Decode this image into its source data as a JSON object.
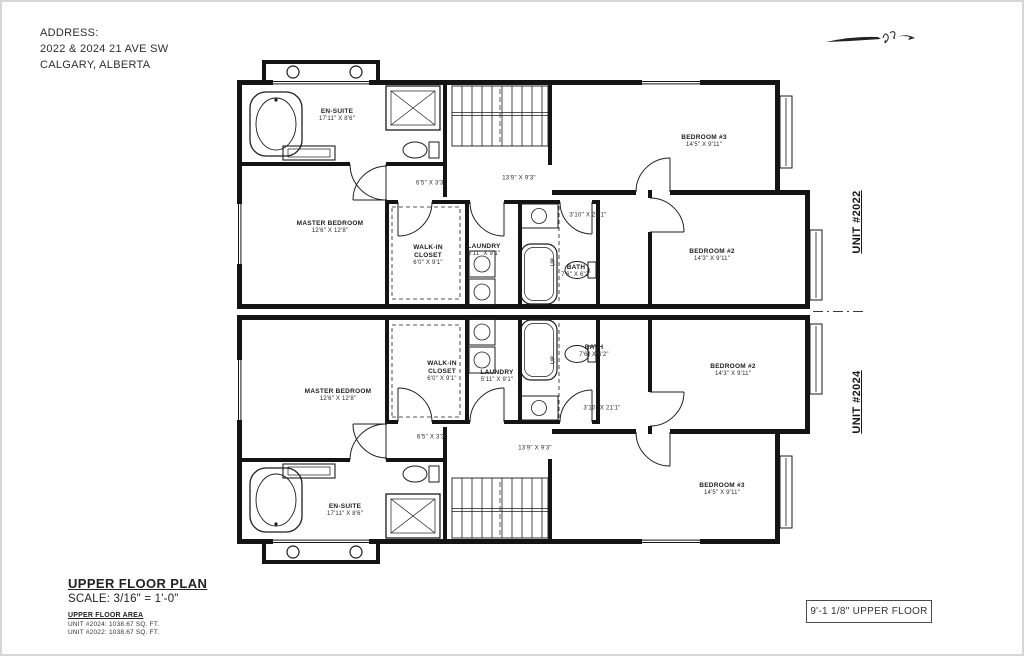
{
  "sheet": {
    "address": {
      "label": "ADDRESS:",
      "line1": "2022 & 2024 21 AVE SW",
      "line2": "CALGARY, ALBERTA"
    },
    "units": {
      "upper": "UNIT #2022",
      "lower": "UNIT #2024"
    },
    "title_block": {
      "title": "UPPER FLOOR PLAN",
      "scale": "SCALE: 3/16\" = 1'-0\"",
      "area_heading": "UPPER FLOOR AREA",
      "area_lines": [
        "UNIT #2024: 1038.67 SQ. FT.",
        "UNIT #2022: 1038.67 SQ. FT."
      ]
    },
    "elevation_tag": "9'-1 1/8\" UPPER FLOOR"
  },
  "rooms": {
    "ensuite": {
      "name": "EN-SUITE",
      "dims": "17'11\" X 8'6\""
    },
    "master": {
      "name": "MASTER BEDROOM",
      "dims": "12'6\" X 12'8\""
    },
    "wic": {
      "name": "WALK-IN CLOSET",
      "dims": "6'0\" X 9'1\""
    },
    "laundry": {
      "name": "LAUNDRY",
      "dims": "5'11\" X 9'1\""
    },
    "bath": {
      "name": "BATH",
      "dims": "7'6\" X 6'2\""
    },
    "bedroom2": {
      "name": "BEDROOM #2",
      "dims": "14'3\" X 9'11\""
    },
    "bedroom3": {
      "name": "BEDROOM #3",
      "dims": "14'5\" X 9'11\""
    }
  },
  "dims": {
    "stair_hall": "13'9\" X 9'3\"",
    "niche": "6'5\" X 3'3\"",
    "hallway": "3'10\" X 21'1\"",
    "stair_direction": "UP"
  }
}
